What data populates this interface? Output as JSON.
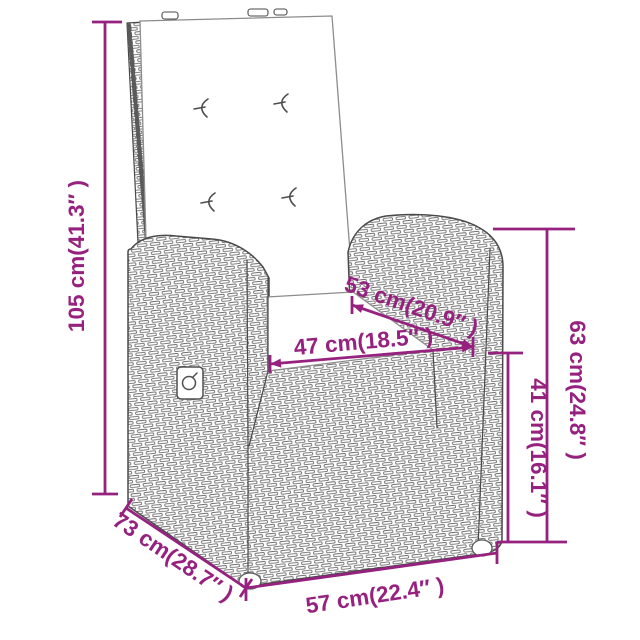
{
  "diagram": {
    "type": "product-dimension-diagram",
    "product": "wicker reclining chair with back and seat cushions",
    "accent_color": "#96217F",
    "line_color": "#4a4a4a",
    "dimensions": {
      "overall_height": {
        "label": "105 cm(41.3″ )",
        "cm": 105,
        "in": 41.3
      },
      "seat_depth": {
        "label": "53 cm(20.9″ )",
        "cm": 53,
        "in": 20.9
      },
      "seat_width": {
        "label": "47 cm(18.5″ )",
        "cm": 47,
        "in": 18.5
      },
      "armrest_height": {
        "label": "63 cm(24.8″ )",
        "cm": 63,
        "in": 24.8
      },
      "seat_height": {
        "label": "41 cm(16.1″ )",
        "cm": 41,
        "in": 16.1
      },
      "overall_depth": {
        "label": "73 cm(28.7″ )",
        "cm": 73,
        "in": 28.7
      },
      "overall_width": {
        "label": "57 cm(22.4″ )",
        "cm": 57,
        "in": 22.4
      }
    }
  }
}
